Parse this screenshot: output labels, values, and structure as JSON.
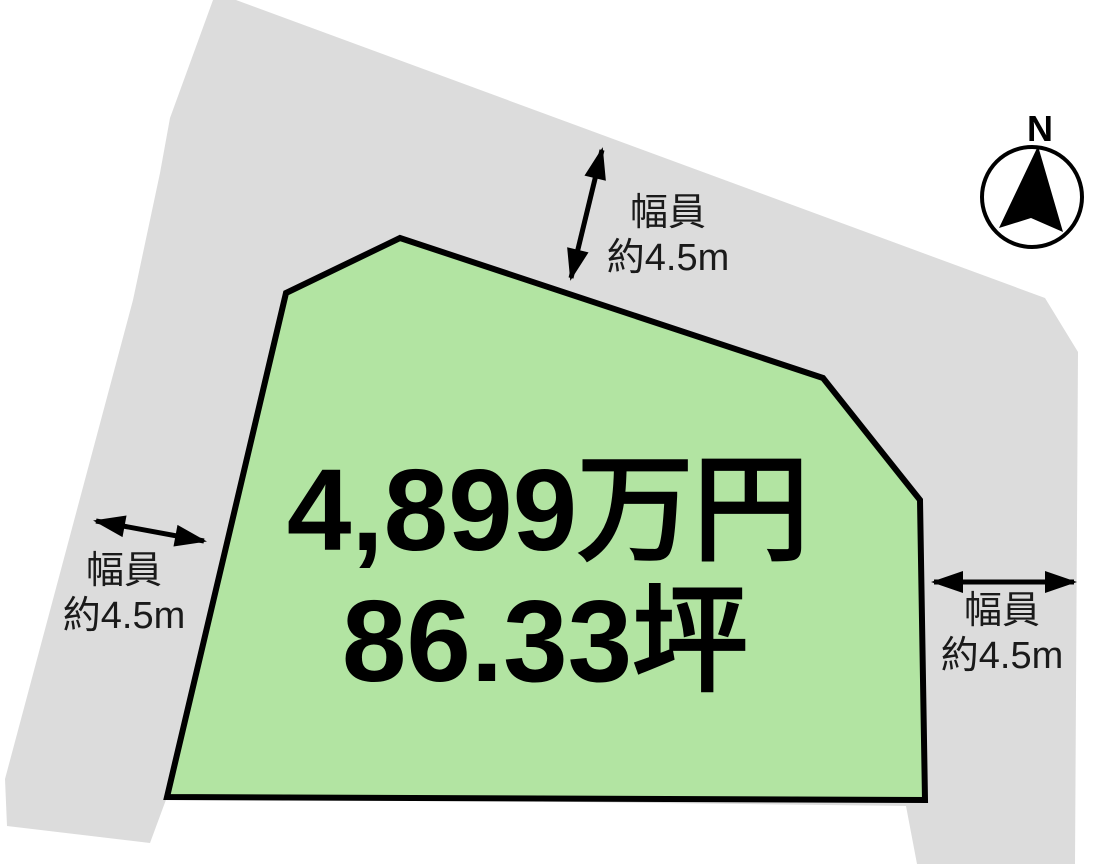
{
  "plot": {
    "price": "4,899万円",
    "area": "86.33坪"
  },
  "road_labels": {
    "top": {
      "line1": "幅員",
      "line2": "約4.5m"
    },
    "left": {
      "line1": "幅員",
      "line2": "約4.5m"
    },
    "right": {
      "line1": "幅員",
      "line2": "約4.5m"
    }
  },
  "compass": {
    "north_label": "N"
  },
  "colors": {
    "road_fill": "#dcdcdc",
    "plot_fill": "#b2e4a2",
    "outline": "#000000",
    "label_text": "#1a1a1a"
  },
  "geometry": {
    "road_points": "213,0 236,0 1045,298 1078,352 1075,864 917,864 906,806 167,797 150,843 7,826 5,779 133,300 160,173 170,118",
    "plot_points": "286,293 400,238 823,378 920,500 925,800 167,797",
    "needle_points": "1038,146 1063,232 1031,218 999,228"
  }
}
